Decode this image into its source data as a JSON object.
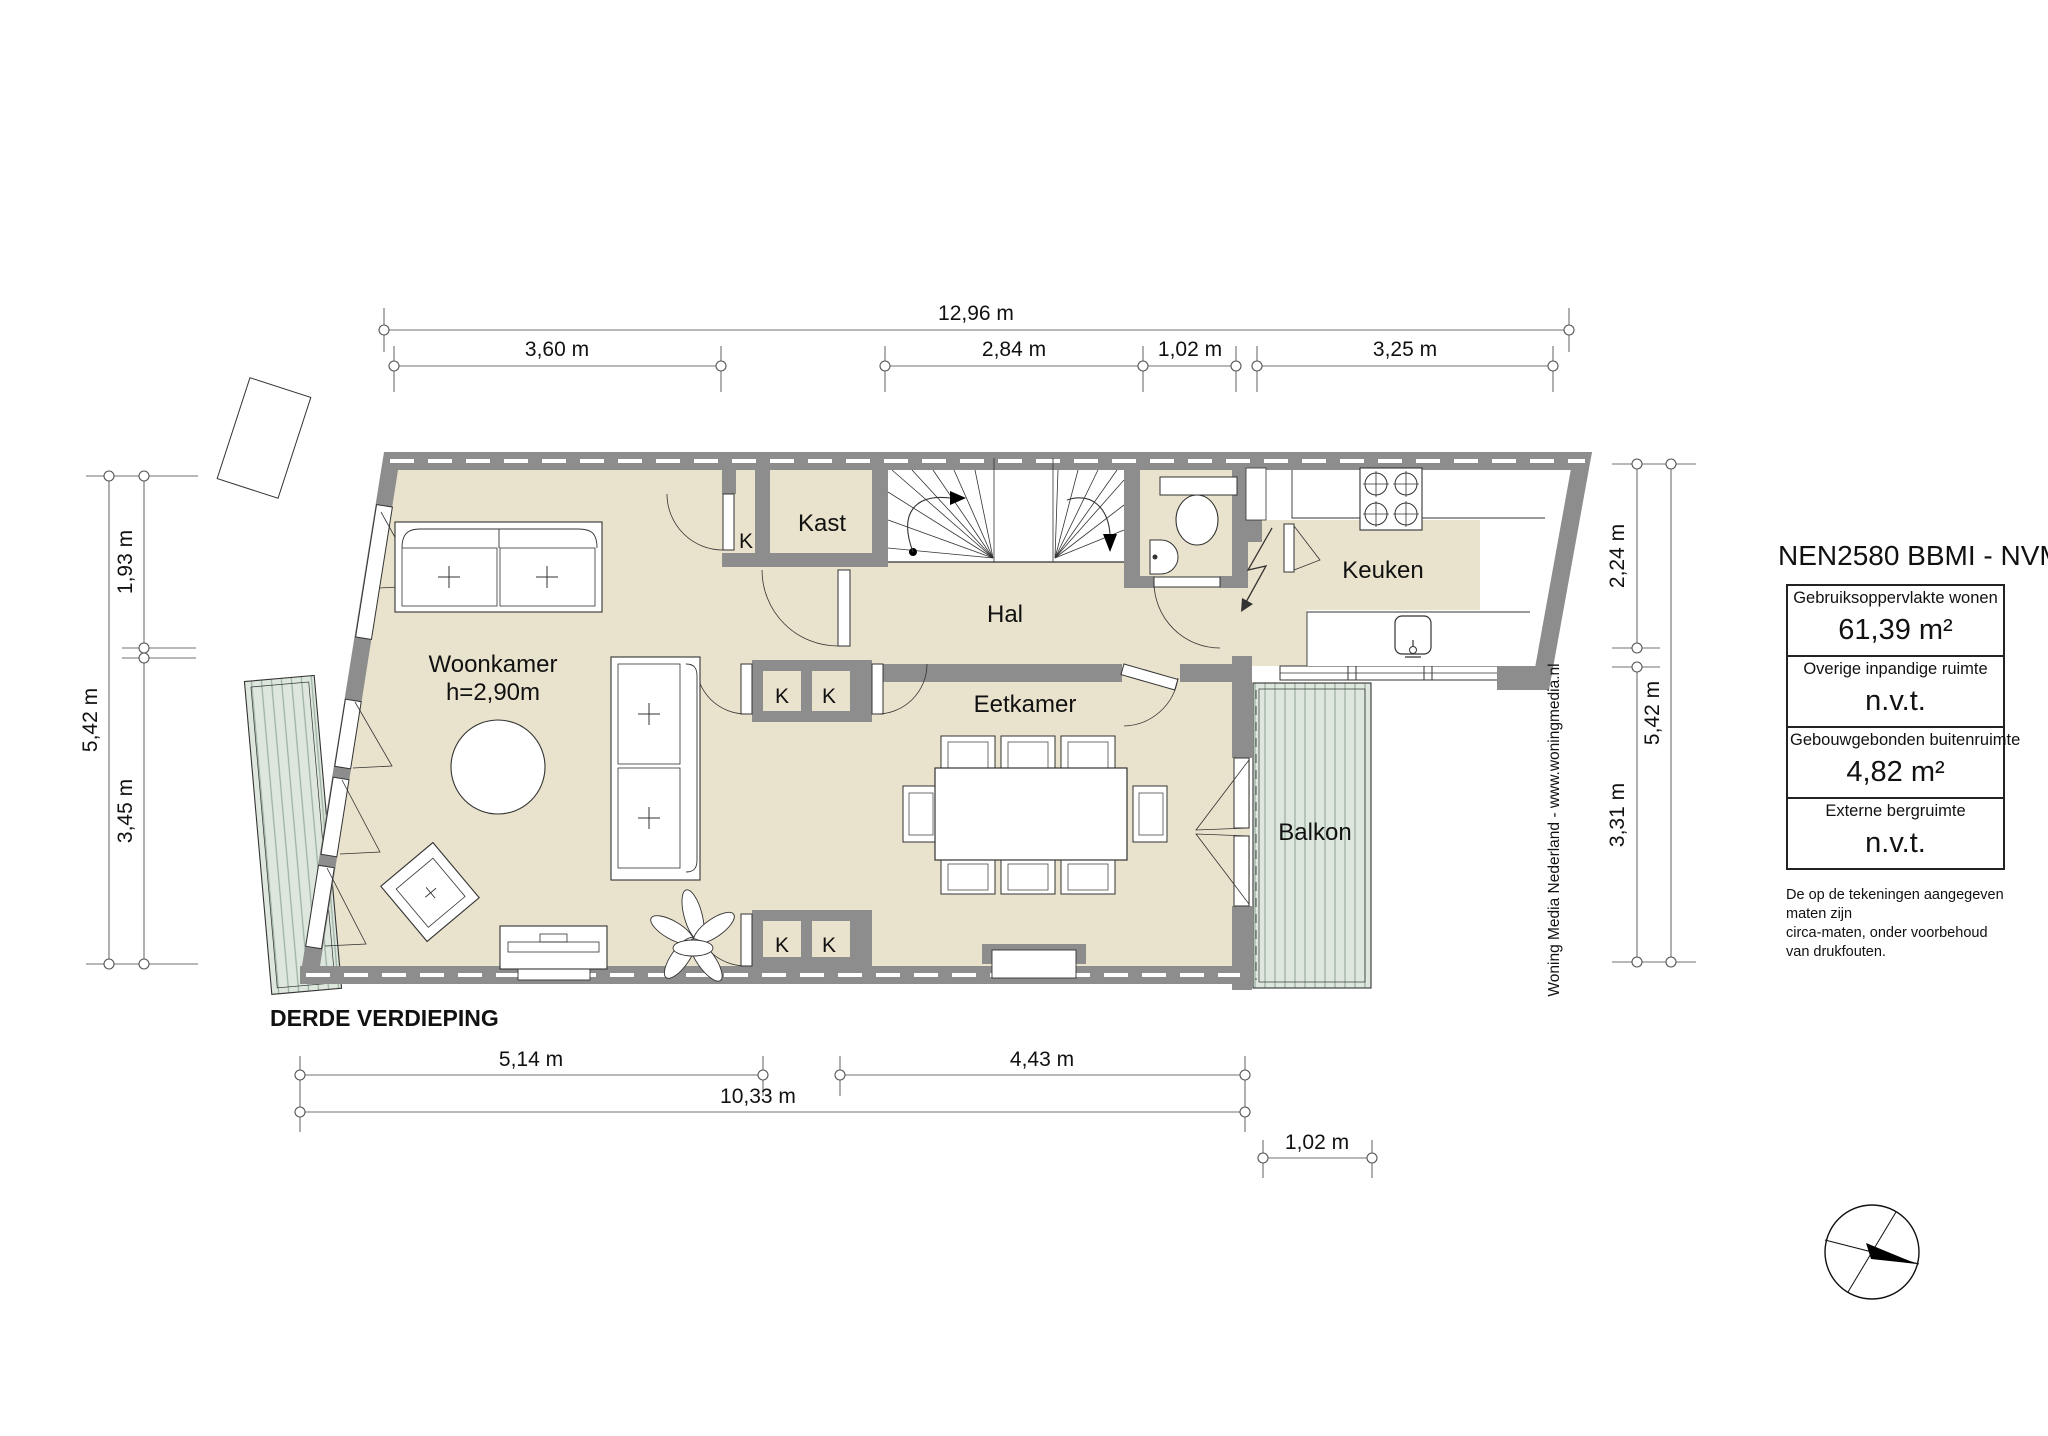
{
  "floor_title": "DERDE VERDIEPING",
  "rooms": {
    "woonkamer": {
      "label": "Woonkamer",
      "ceiling_height": "h=2,90m"
    },
    "kast": {
      "label": "Kast"
    },
    "hal": {
      "label": "Hal"
    },
    "eetkamer": {
      "label": "Eetkamer"
    },
    "keuken": {
      "label": "Keuken"
    },
    "balkon": {
      "label": "Balkon"
    },
    "closet_abbr": "K"
  },
  "dimensions": {
    "top": {
      "total": "12,96 m",
      "segments": [
        "3,60 m",
        "2,84 m",
        "1,02 m",
        "3,25 m"
      ]
    },
    "left": {
      "total": "5,42 m",
      "segments": [
        "1,93 m",
        "3,45 m"
      ]
    },
    "right": {
      "total": "5,42 m",
      "segments": [
        "2,24 m",
        "3,31 m"
      ]
    },
    "bottom": {
      "segments": [
        "5,14 m",
        "4,43 m"
      ],
      "total": "10,33 m",
      "balcony_width": "1,02 m"
    }
  },
  "legend": {
    "title": "NEN2580 BBMI - NVM",
    "rows": [
      {
        "label": "Gebruiksoppervlakte wonen",
        "value": "61,39 m²"
      },
      {
        "label": "Overige inpandige ruimte",
        "value": "n.v.t."
      },
      {
        "label": "Gebouwgebonden buitenruimte",
        "value": "4,82 m²"
      },
      {
        "label": "Externe bergruimte",
        "value": "n.v.t."
      }
    ],
    "disclaimer": [
      "De op de tekeningen aangegeven maten zijn",
      "circa-maten, onder voorbehoud van drukfouten."
    ]
  },
  "credit": "Woning Media Nederland - www.woningmedia.nl",
  "colors": {
    "wall": "#8d8d8d",
    "floor": "#e9e2cc",
    "balcony_deck": "#dde7dd",
    "balcony_stripe": "#9db3a3",
    "dimension_line": "#707070"
  }
}
